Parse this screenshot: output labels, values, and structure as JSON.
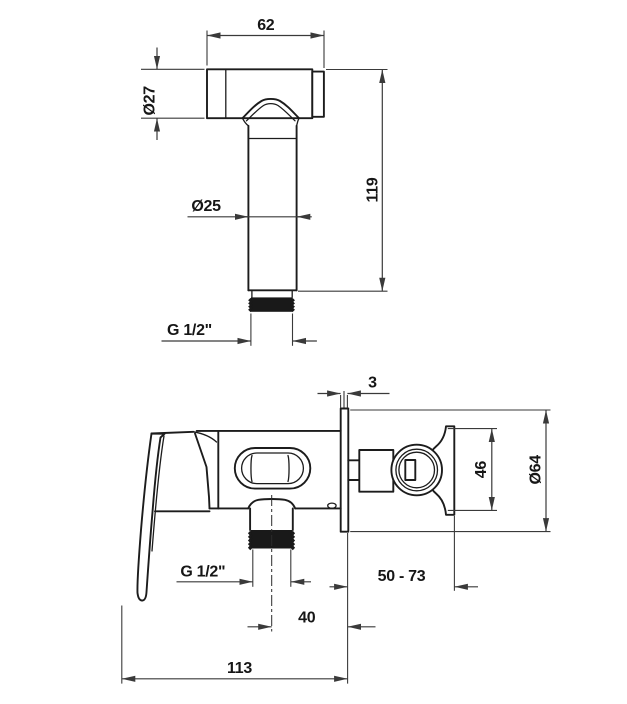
{
  "colors": {
    "background": "#ffffff",
    "part_line": "#1c1c1c",
    "dimension_line": "#3a3a3a",
    "text": "#161616"
  },
  "handset_drawing": {
    "head_width": "62",
    "head_diameter": "Ø27",
    "handle_diameter": "Ø25",
    "total_height": "119",
    "thread": "G 1/2\""
  },
  "mixer_drawing": {
    "plate_thickness": "3",
    "connector_height": "46",
    "plate_diameter": "Ø64",
    "thread": "G 1/2\"",
    "outlet_to_wall": "40",
    "wall_depth_range": "50 - 73",
    "overall_width": "113"
  }
}
